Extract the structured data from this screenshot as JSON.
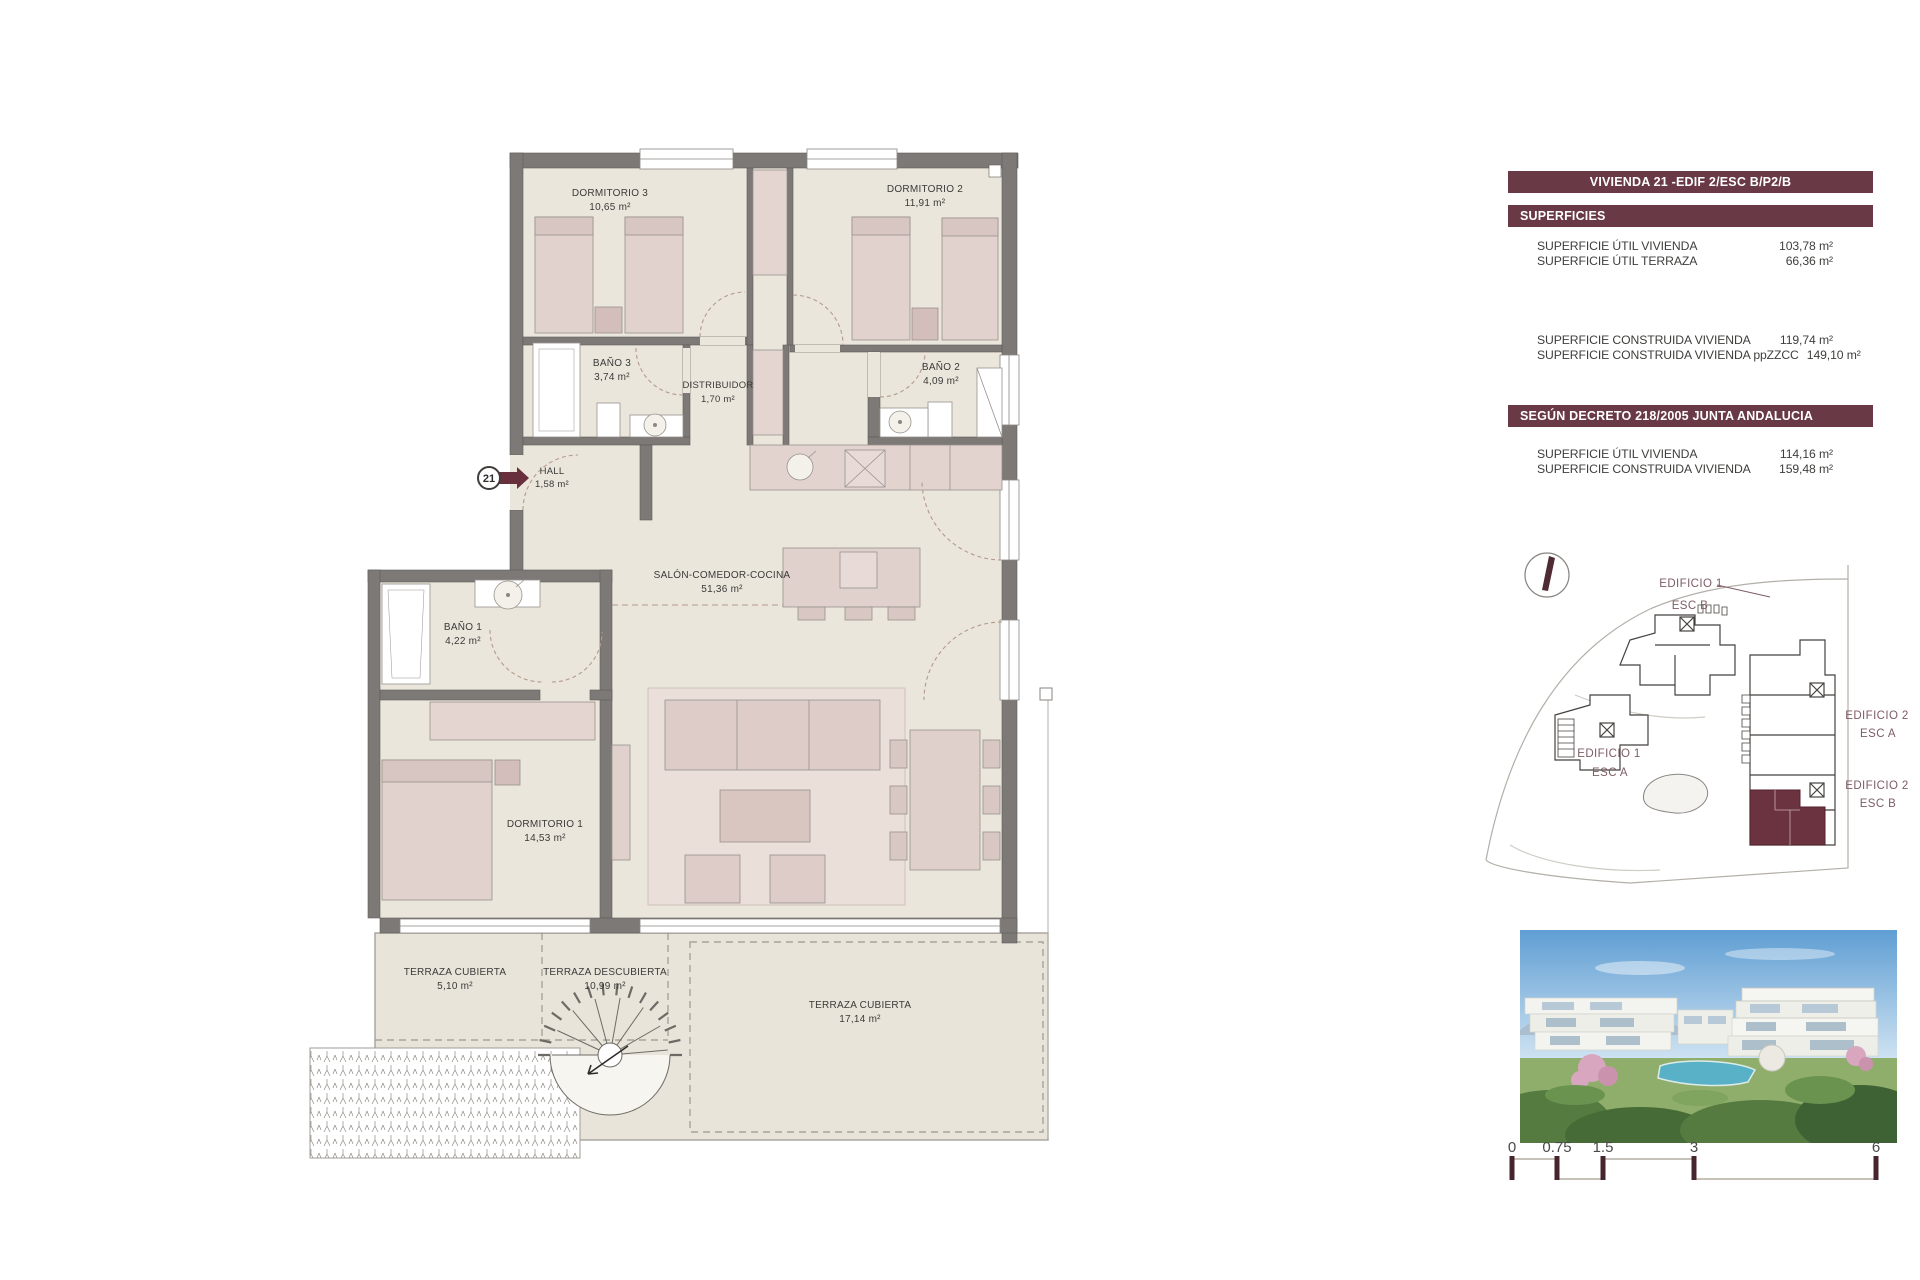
{
  "header": {
    "title": "VIVIENDA 21 -EDIF 2/ESC B/P2/B"
  },
  "superficies": {
    "header": "SUPERFICIES",
    "util": [
      {
        "label": "SUPERFICIE ÚTIL VIVIENDA",
        "value": "103,78 m²"
      },
      {
        "label": "SUPERFICIE ÚTIL TERRAZA",
        "value": "66,36 m²"
      }
    ],
    "construida": [
      {
        "label": "SUPERFICIE CONSTRUIDA VIVIENDA",
        "value": "119,74 m²"
      },
      {
        "label": "SUPERFICIE CONSTRUIDA VIVIENDA ppZZCC",
        "value": "149,10 m²"
      }
    ]
  },
  "decreto": {
    "header": "SEGÚN DECRETO 218/2005 JUNTA ANDALUCIA",
    "rows": [
      {
        "label": "SUPERFICIE ÚTIL VIVIENDA",
        "value": "114,16 m²"
      },
      {
        "label": "SUPERFICIE CONSTRUIDA VIVIENDA",
        "value": "159,48 m²"
      }
    ]
  },
  "floorplan": {
    "unit_badge": "21",
    "rooms": [
      {
        "name": "DORMITORIO 3",
        "area": "10,65 m²"
      },
      {
        "name": "DORMITORIO 2",
        "area": "11,91 m²"
      },
      {
        "name": "BAÑO 3",
        "area": "3,74 m²"
      },
      {
        "name": "DISTRIBUIDOR",
        "area": "1,70 m²"
      },
      {
        "name": "BAÑO 2",
        "area": "4,09 m²"
      },
      {
        "name": "HALL",
        "area": "1,58 m²"
      },
      {
        "name": "SALÓN-COMEDOR-COCINA",
        "area": "51,36 m²"
      },
      {
        "name": "BAÑO 1",
        "area": "4,22 m²"
      },
      {
        "name": "DORMITORIO 1",
        "area": "14,53 m²"
      },
      {
        "name": "TERRAZA CUBIERTA",
        "area": "5,10 m²"
      },
      {
        "name": "TERRAZA DESCUBIERTA",
        "area": "10,99 m²"
      },
      {
        "name": "TERRAZA CUBIERTA",
        "area": "17,14 m²"
      }
    ]
  },
  "siteplan": {
    "labels": [
      {
        "building": "EDIFICIO 1",
        "stair": "ESC B"
      },
      {
        "building": "EDIFICIO 1",
        "stair": "ESC A"
      },
      {
        "building": "EDIFICIO 2",
        "stair": "ESC A"
      },
      {
        "building": "EDIFICIO 2",
        "stair": "ESC B"
      }
    ]
  },
  "scalebar": {
    "ticks": [
      "0",
      "0.75",
      "1.5",
      "3",
      "6"
    ]
  },
  "colors": {
    "accent_maroon": "#693945",
    "highlight_unit": "#6b3340",
    "wall_gray": "#7d7977",
    "floor_beige": "#ebe6dc",
    "furniture_pink": "#e2d2ce",
    "scale_tick": "#47252e"
  }
}
